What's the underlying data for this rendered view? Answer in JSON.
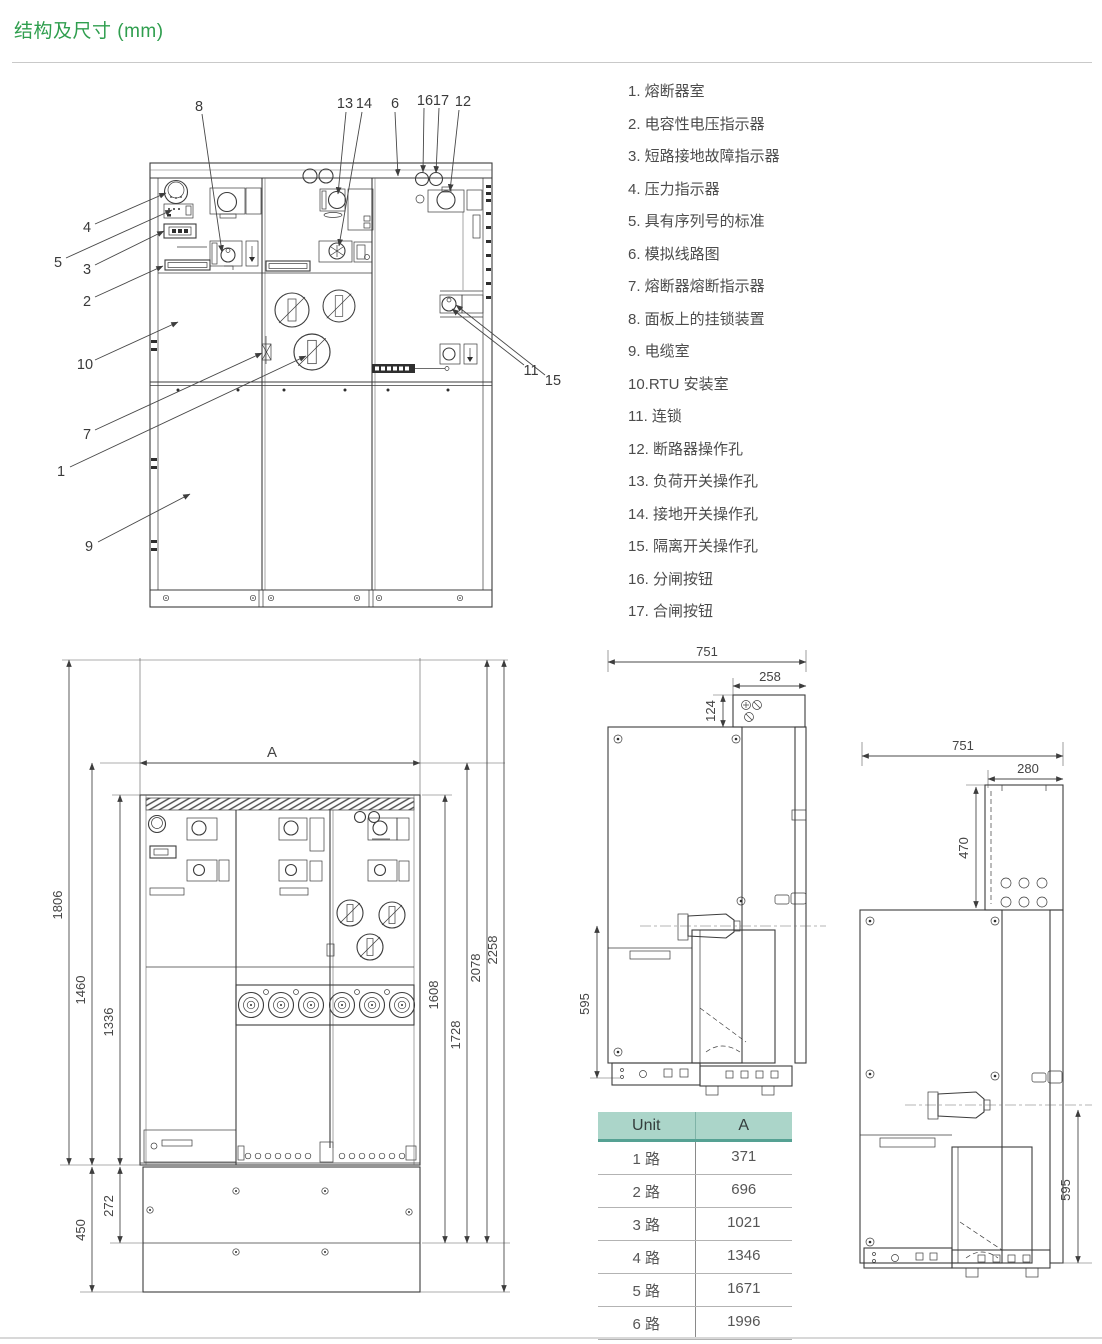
{
  "page": {
    "title": "结构及尺寸 (mm)"
  },
  "colors": {
    "accent_green": "#2f9e4e",
    "table_header_bg": "#abd5c9",
    "table_header_border": "#55a193",
    "line_art": "#3c3c3c"
  },
  "legend": {
    "items": [
      "1. 熔断器室",
      "2. 电容性电压指示器",
      "3. 短路接地故障指示器",
      "4. 压力指示器",
      "5. 具有序列号的标准",
      "6. 模拟线路图",
      "7. 熔断器熔断指示器",
      "8. 面板上的挂锁装置",
      "9. 电缆室",
      "10.RTU 安装室",
      "11. 连锁",
      "12. 断路器操作孔",
      "13. 负荷开关操作孔",
      "14. 接地开关操作孔",
      "15. 隔离开关操作孔",
      "16. 分闸按钮",
      "17. 合闸按钮"
    ]
  },
  "front_view": {
    "callouts": {
      "n1": "1",
      "n2": "2",
      "n3": "3",
      "n4": "4",
      "n5": "5",
      "n6": "6",
      "n7": "7",
      "n8": "8",
      "n9": "9",
      "n10": "10",
      "n11": "11",
      "n12": "12",
      "n13": "13",
      "n14": "14",
      "n15": "15",
      "n16": "16",
      "n17": "17"
    }
  },
  "dimension_view": {
    "a_label": "A",
    "d1806": "1806",
    "d1460": "1460",
    "d1336": "1336",
    "d272": "272",
    "d450": "450",
    "d1608": "1608",
    "d1728": "1728",
    "d2078": "2078",
    "d2258": "2258"
  },
  "side_view_top": {
    "d751": "751",
    "d258": "258",
    "d124": "124",
    "d595": "595"
  },
  "side_view_right": {
    "d751": "751",
    "d280": "280",
    "d470": "470",
    "d595": "595"
  },
  "spec_table": {
    "headers": {
      "unit": "Unit",
      "a": "A"
    },
    "rows": [
      {
        "unit": "1 路",
        "a": "371"
      },
      {
        "unit": "2 路",
        "a": "696"
      },
      {
        "unit": "3 路",
        "a": "1021"
      },
      {
        "unit": "4 路",
        "a": "1346"
      },
      {
        "unit": "5 路",
        "a": "1671"
      },
      {
        "unit": "6 路",
        "a": "1996"
      }
    ]
  }
}
